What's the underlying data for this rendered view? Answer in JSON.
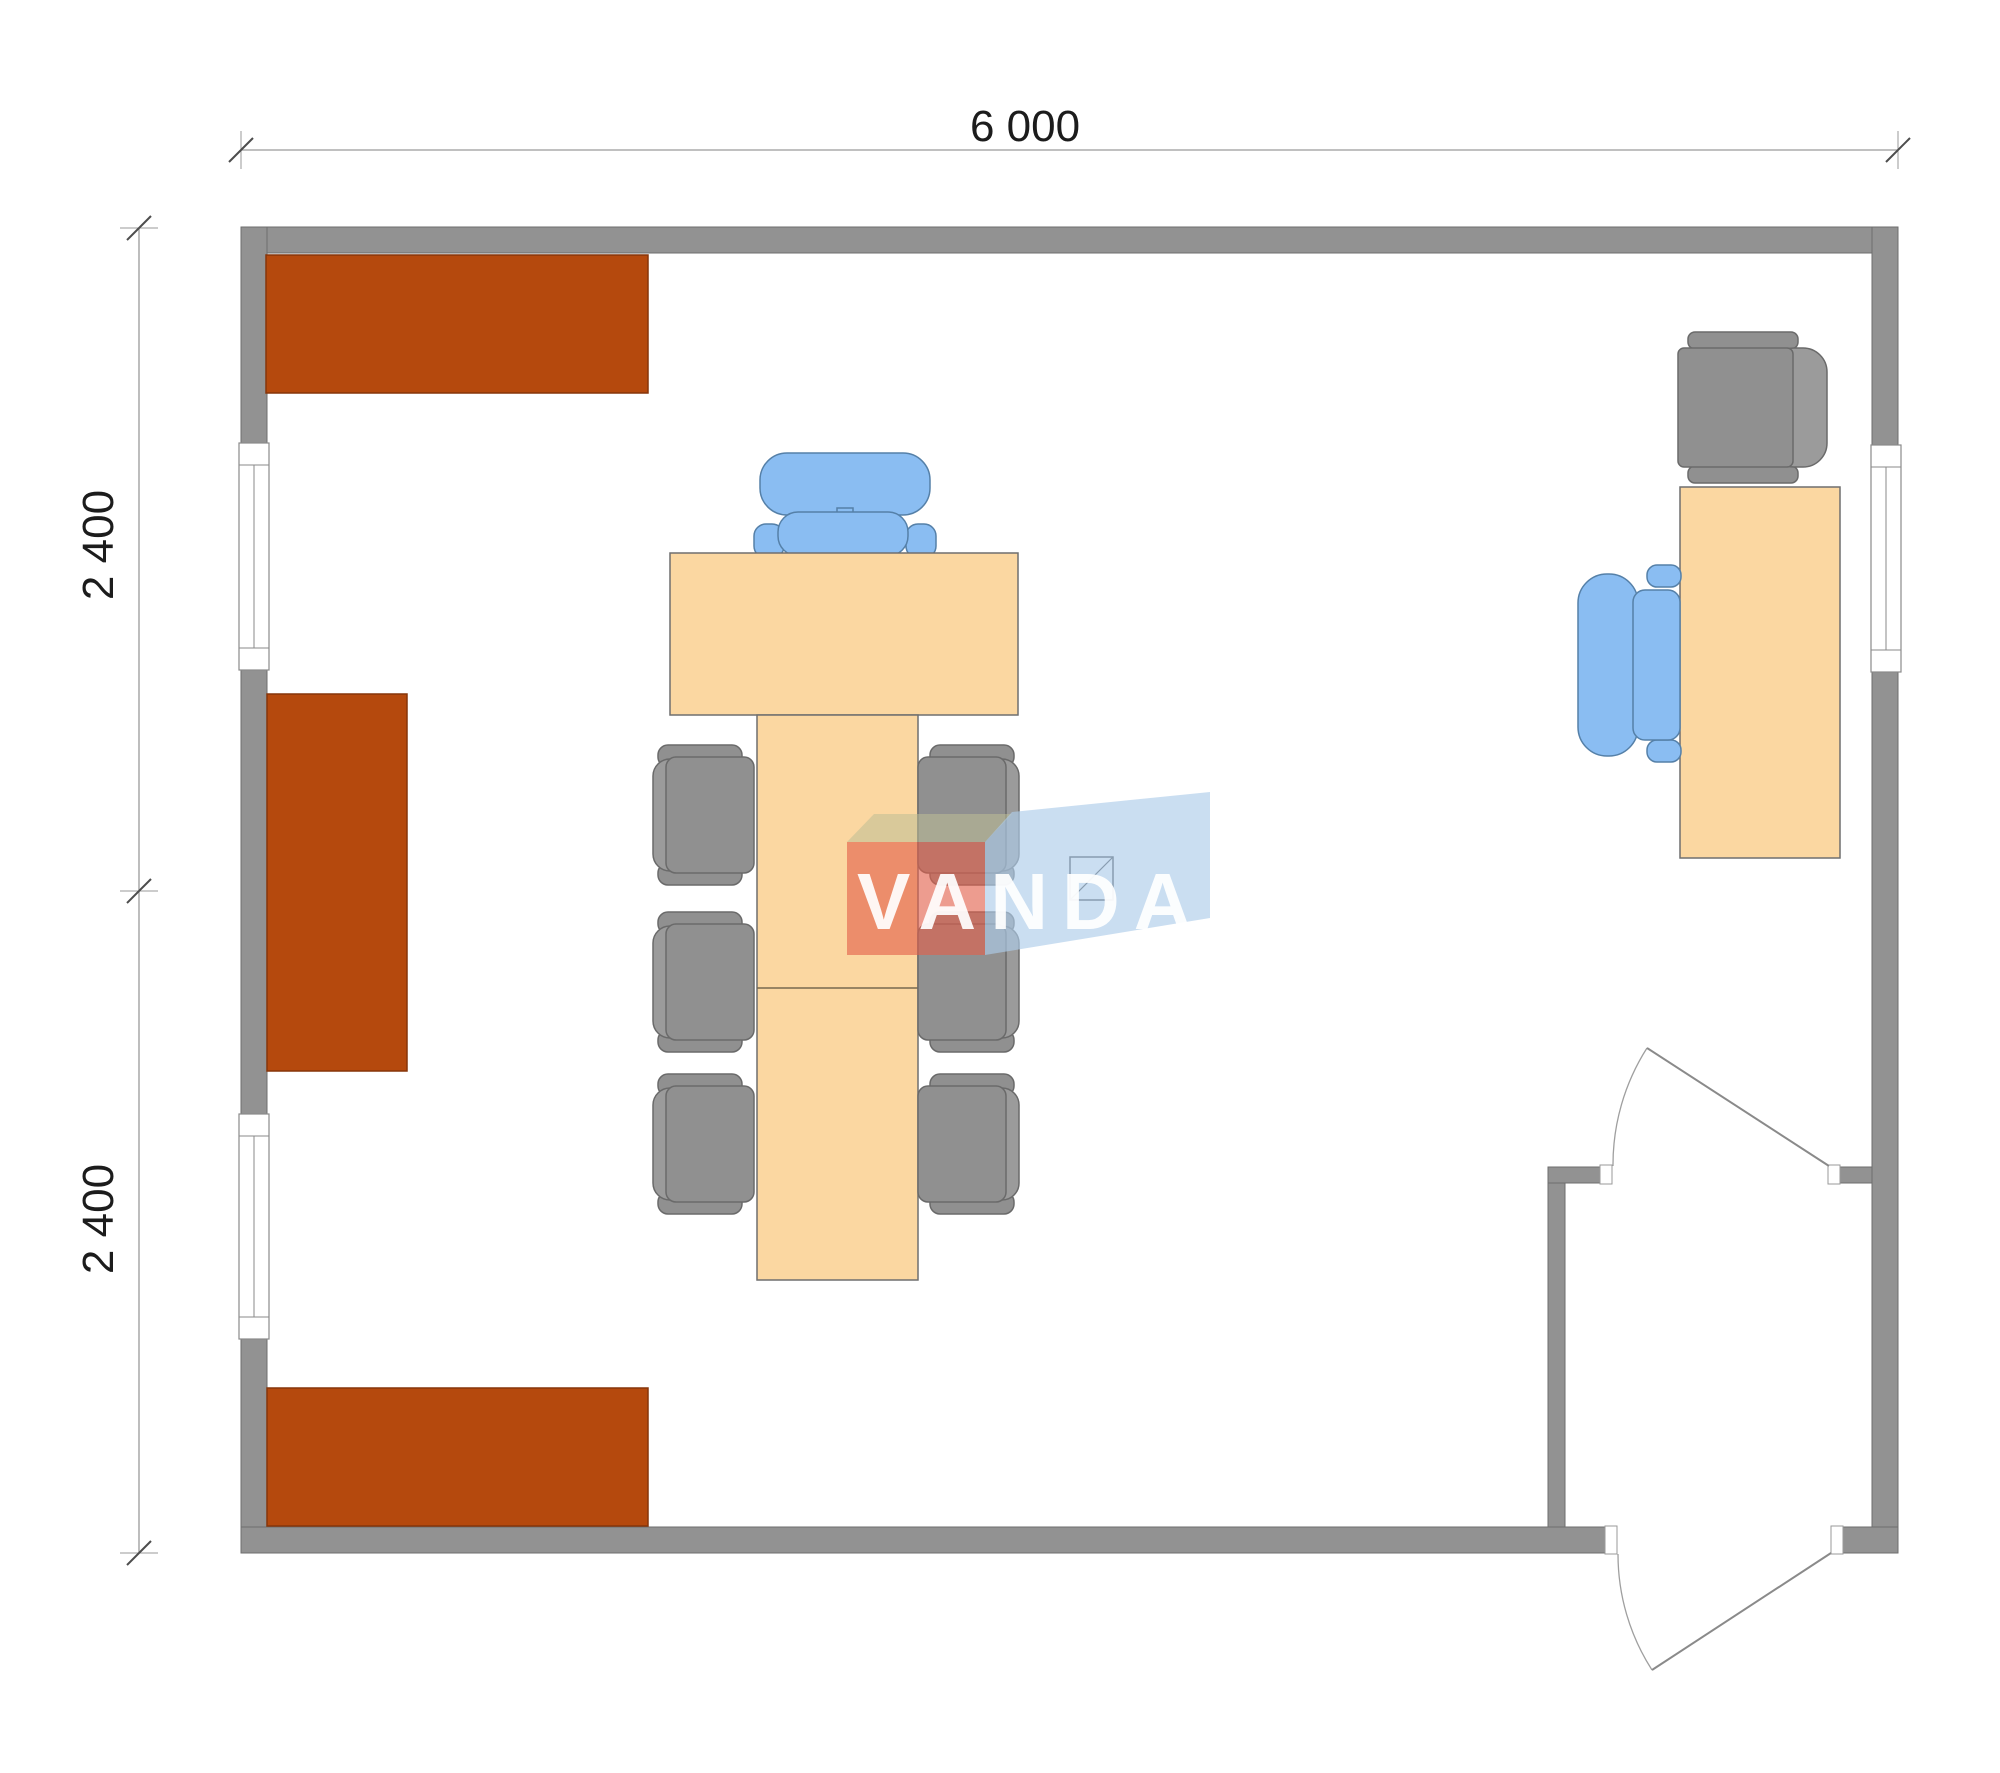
{
  "page": {
    "title": "Floor plan with VANDA watermark"
  },
  "dimensions": {
    "width_label": "6 000",
    "left_upper_label": "2 400",
    "left_lower_label": "2 400"
  },
  "watermark": {
    "text": "VANDA"
  },
  "colors": {
    "background": "#ffffff",
    "wall": "#929292",
    "cabinet": "#b5490d",
    "table": "#fbd7a1",
    "gray_chair": "#909090",
    "blue_chair": "#8abdf2",
    "watermark_front": "#e2604a",
    "watermark_side": "#aecdea",
    "watermark_top": "#bdbd96",
    "dimension_text": "#1c1c1c"
  },
  "plan": {
    "walls": "rectangular room 6000 x 4800 with entry vestibule bottom-right",
    "windows": [
      "left-wall-window-upper",
      "left-wall-window-lower",
      "right-wall-window"
    ],
    "doors": [
      "vestibule-inner-door",
      "vestibule-exterior-door"
    ],
    "furniture": [
      {
        "name": "wall-cabinet-top",
        "color": "#b5490d"
      },
      {
        "name": "wall-cabinet-left",
        "color": "#b5490d"
      },
      {
        "name": "wall-cabinet-bottom",
        "color": "#b5490d"
      },
      {
        "name": "conference-table",
        "color": "#fbd7a1"
      },
      {
        "name": "executive-chair",
        "color": "#8abdf2"
      },
      {
        "name": "visitor-chairs-gray",
        "count": 6,
        "color": "#909090"
      },
      {
        "name": "office-desk",
        "color": "#fbd7a1"
      },
      {
        "name": "desk-chair-blue",
        "color": "#8abdf2"
      },
      {
        "name": "armchair-gray",
        "color": "#909090"
      },
      {
        "name": "ceiling-light-symbol",
        "color": "#ffffff"
      }
    ]
  }
}
